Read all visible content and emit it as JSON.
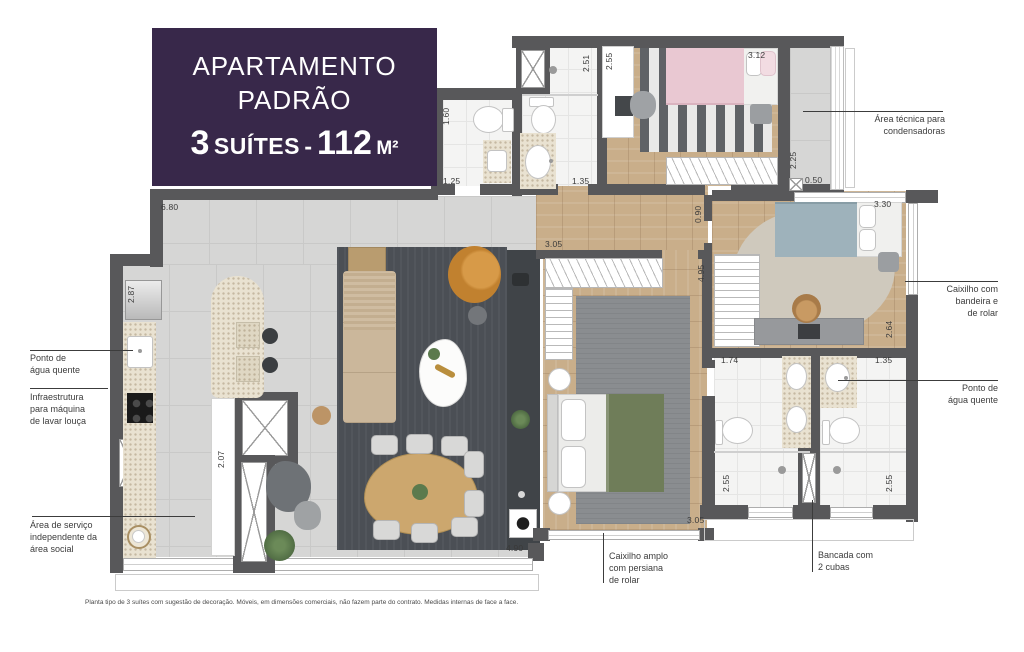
{
  "title_card": {
    "line1": "APARTAMENTO",
    "line2": "PADRÃO",
    "area": {
      "count": "3",
      "label": "SUÍTES",
      "sep": "-",
      "value": "112",
      "unit": "M²"
    }
  },
  "callouts": {
    "area_tecnica": "Área técnica para\ncondensadoras",
    "caixilho_bandeira": "Caixilho com\nbandeira e\nde rolar",
    "ponto_agua_direita": "Ponto de\nágua quente",
    "ponto_agua_esquerda": "Ponto de\nágua quente",
    "infraestrutura": "Infraestrutura\npara máquina\nde lavar louça",
    "area_servico": "Área de serviço\nindependente da\nárea social",
    "caixilho_amplo": "Caixilho amplo\ncom persiana\nde rolar",
    "bancada": "Bancada com\n2 cubas"
  },
  "dimensions": [
    {
      "value": "6.80",
      "x": 161,
      "y": 202,
      "vertical": false
    },
    {
      "value": "2.87",
      "x": 126,
      "y": 303,
      "vertical": true
    },
    {
      "value": "2.07",
      "x": 216,
      "y": 468,
      "vertical": true
    },
    {
      "value": "4.90",
      "x": 506,
      "y": 543,
      "vertical": false
    },
    {
      "value": "1.60",
      "x": 441,
      "y": 125,
      "vertical": true
    },
    {
      "value": "1.25",
      "x": 443,
      "y": 176,
      "vertical": false
    },
    {
      "value": "2.51",
      "x": 581,
      "y": 72,
      "vertical": true
    },
    {
      "value": "2.55",
      "x": 604,
      "y": 70,
      "vertical": true
    },
    {
      "value": "1.35",
      "x": 572,
      "y": 176,
      "vertical": false
    },
    {
      "value": "3.12",
      "x": 748,
      "y": 50,
      "vertical": false
    },
    {
      "value": "2.25",
      "x": 788,
      "y": 169,
      "vertical": true
    },
    {
      "value": "0.50",
      "x": 805,
      "y": 175,
      "vertical": false
    },
    {
      "value": "3.30",
      "x": 874,
      "y": 199,
      "vertical": false
    },
    {
      "value": "0.90",
      "x": 693,
      "y": 223,
      "vertical": true
    },
    {
      "value": "3.05",
      "x": 545,
      "y": 239,
      "vertical": false
    },
    {
      "value": "4.95",
      "x": 696,
      "y": 282,
      "vertical": true
    },
    {
      "value": "2.64",
      "x": 884,
      "y": 338,
      "vertical": true
    },
    {
      "value": "1.74",
      "x": 721,
      "y": 355,
      "vertical": false
    },
    {
      "value": "1.35",
      "x": 875,
      "y": 355,
      "vertical": false
    },
    {
      "value": "2.55",
      "x": 721,
      "y": 492,
      "vertical": true
    },
    {
      "value": "2.55",
      "x": 884,
      "y": 492,
      "vertical": true
    },
    {
      "value": "3.05",
      "x": 687,
      "y": 515,
      "vertical": false
    }
  ],
  "disclaimer": "Planta tipo de 3 suítes com sugestão de decoração. Móveis, em dimensões comerciais, não fazem parte do contrato. Medidas internas de face a face.",
  "colors": {
    "brand_purple": "#38284A",
    "wall": "#58585A",
    "wood_floor": "#C9AE8A",
    "tile_floor": "#D6D6D5",
    "bath_floor": "#F4F4F3",
    "counter_stone": "#E9E2D1",
    "rug_dark": "#4B4F55",
    "armchair_mustard": "#C1812F",
    "bed_green": "#6F7D59",
    "bed_blue": "#9EB2BB",
    "bed_pink": "#E9C8D2"
  }
}
